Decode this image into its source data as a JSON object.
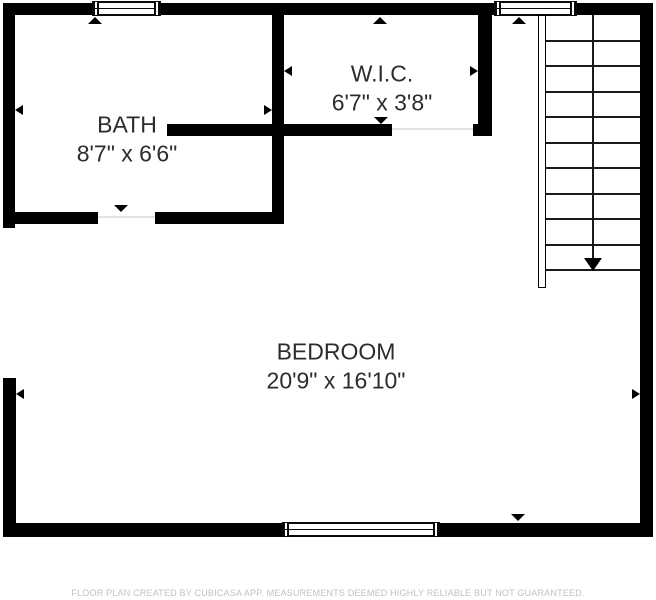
{
  "plan": {
    "rooms": [
      {
        "id": "bath",
        "name": "BATH",
        "dimensions": "8'7\" x 6'6\""
      },
      {
        "id": "wic",
        "name": "W.I.C.",
        "dimensions": "6'7\" x 3'8\""
      },
      {
        "id": "bedroom",
        "name": "BEDROOM",
        "dimensions": "20'9\" x 16'10\""
      }
    ],
    "stairs": {
      "tread_count": 10,
      "direction": "down"
    },
    "window_count": 3,
    "colors": {
      "wall": "#000000",
      "room_text": "#2c2c2c",
      "disclaimer_text": "#c2c2c2",
      "background": "#ffffff"
    },
    "disclaimer": "FLOOR PLAN CREATED BY CUBICASA APP. MEASUREMENTS DEEMED HIGHLY RELIABLE BUT NOT GUARANTEED."
  }
}
